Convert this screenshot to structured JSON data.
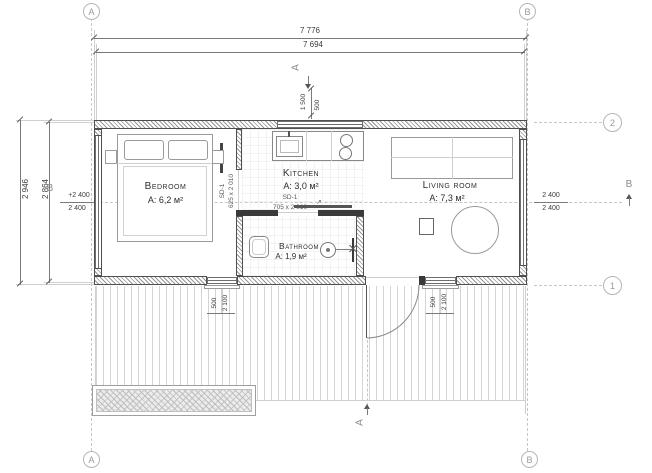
{
  "plan": {
    "grid": {
      "a": "A",
      "b": "B",
      "r1": "1",
      "r2": "2"
    },
    "sections": {
      "a": "A",
      "b": "B"
    },
    "arrows": {
      "ne": "↗"
    },
    "dims": {
      "w_out": "7 776",
      "w_in": "7 694",
      "d_out": "2 946",
      "d_in": "2 864",
      "lvl_l1": "+2 400",
      "lvl_l2": "2 400",
      "lvl_r1": "2 400",
      "lvl_r2": "2 400",
      "s1": "1 500",
      "s2": "500",
      "w1a": "500",
      "w1b": "2 100",
      "w2a": "500",
      "w2b": "2 100"
    },
    "rooms": [
      {
        "name": "Bedroom",
        "area": "A: 6,2 м²"
      },
      {
        "name": "Kitchen",
        "area": "A: 3,0 м²"
      },
      {
        "name": "Living room",
        "area": "A: 7,3 м²"
      },
      {
        "name": "Bathroom",
        "area": "A: 1,9 м²"
      }
    ],
    "doors": [
      {
        "code": "SD-1",
        "size": "625 x 2 010"
      },
      {
        "code": "SD-1",
        "size": "705 x 2 010"
      }
    ]
  }
}
